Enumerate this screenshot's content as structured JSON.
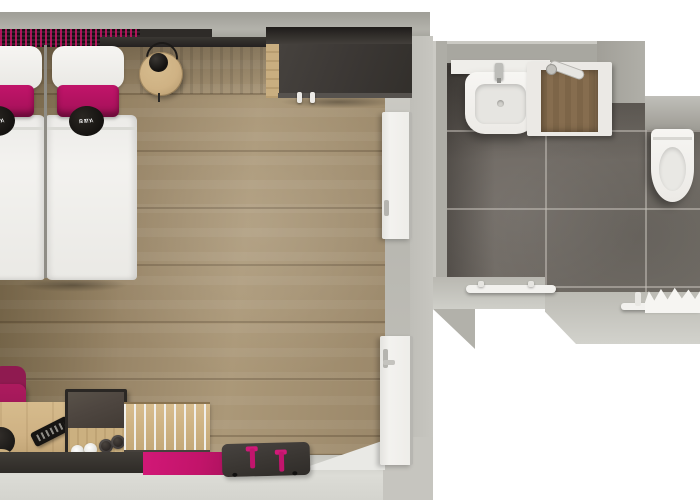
{
  "scene": {
    "title": "Hotel room floor plan - top-down 3D render",
    "rooms": [
      "bedroom",
      "bathroom"
    ]
  },
  "branding": {
    "pillow_text_top": "SMA",
    "pillow_text_bottom": "RTY"
  },
  "colors": {
    "bg": "#ffffff",
    "wall": "#a8a7a0",
    "wall-light": "#c7c6c0",
    "wall-bottom": "#d4d4ce",
    "floor-wood": "#9a8769",
    "floor-wood-dark": "#83704f",
    "floor-wood-light": "#ab9878",
    "tile": "#6f6963",
    "accent-magenta": "#c2146a",
    "accent-magenta-dark": "#8f1a50",
    "dark-furniture": "#3b3734",
    "light-wood": "#cfb284",
    "white-fixture": "#f2f1ee",
    "shower-wood": "#866d4f",
    "lamp-black": "#141210"
  },
  "bedroom": {
    "items": [
      "twin bed left",
      "twin bed right",
      "white pillows",
      "magenta accent pillows",
      "round logo pillows",
      "patterned headboard",
      "wall rail shelf",
      "round wooden bedside table",
      "black table lamp",
      "dark wardrobe with wooden hanging strip",
      "open white bathroom door",
      "white entrance door",
      "magenta desk chair",
      "wooden desk",
      "TV remote control",
      "hospitality tray box with two white cups and two dark cups",
      "slatted wooden luggage rack",
      "dark wall bench",
      "magenta mat",
      "dark luggage bench with pink handles"
    ]
  },
  "bathroom": {
    "items": [
      "white washbasin with faucet",
      "white counter ledge",
      "walk-in shower with wooden floor panel",
      "hand shower sprayer",
      "wall-hung toilet",
      "towel rail left",
      "towel rail right with white towel",
      "dark gray floor tiles"
    ]
  }
}
